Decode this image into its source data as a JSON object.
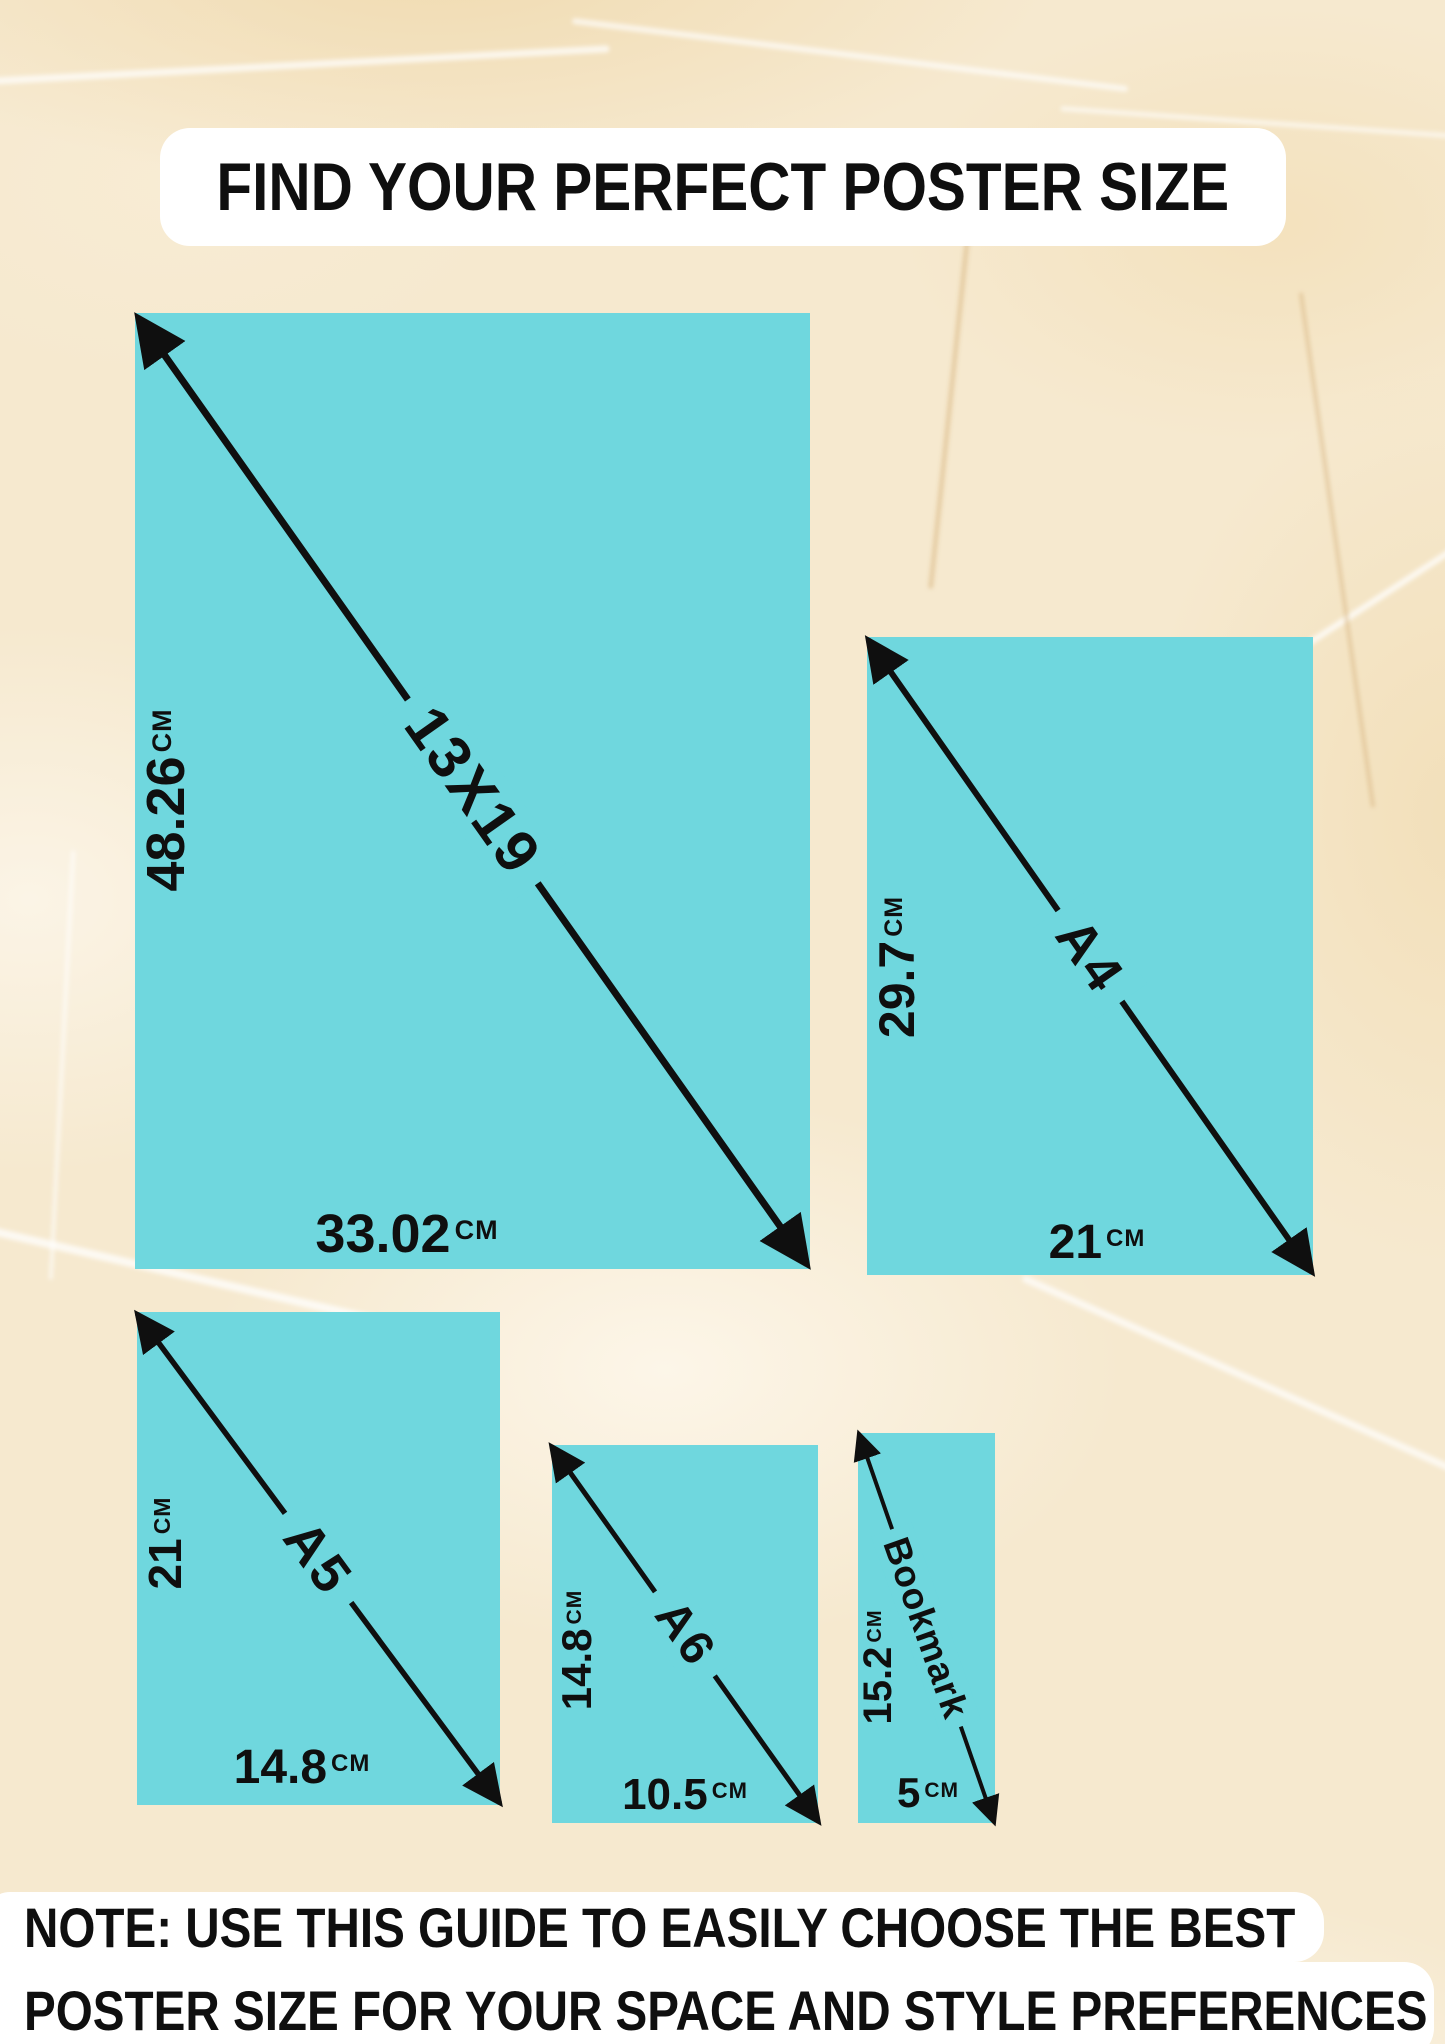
{
  "title": "FIND YOUR PERFECT POSTER SIZE",
  "note": {
    "line1": "NOTE: USE THIS GUIDE TO EASILY CHOOSE THE BEST",
    "line2": "POSTER SIZE FOR YOUR SPACE AND STYLE PREFERENCES"
  },
  "colors": {
    "poster_fill": "#6FD7DE",
    "ink": "#0F0F0F",
    "panel": "#FFFFFF",
    "background": "#F6E9CF"
  },
  "posters": [
    {
      "name": "13X19",
      "height": "48.26",
      "height_unit": "CM",
      "width": "33.02",
      "width_unit": "CM"
    },
    {
      "name": "A4",
      "height": "29.7",
      "height_unit": "CM",
      "width": "21",
      "width_unit": "CM"
    },
    {
      "name": "A5",
      "height": "21",
      "height_unit": "CM",
      "width": "14.8",
      "width_unit": "CM"
    },
    {
      "name": "A6",
      "height": "14.8",
      "height_unit": "CM",
      "width": "10.5",
      "width_unit": "CM"
    },
    {
      "name": "Bookmark",
      "height": "15.2",
      "height_unit": "CM",
      "width": "5",
      "width_unit": "CM"
    }
  ]
}
